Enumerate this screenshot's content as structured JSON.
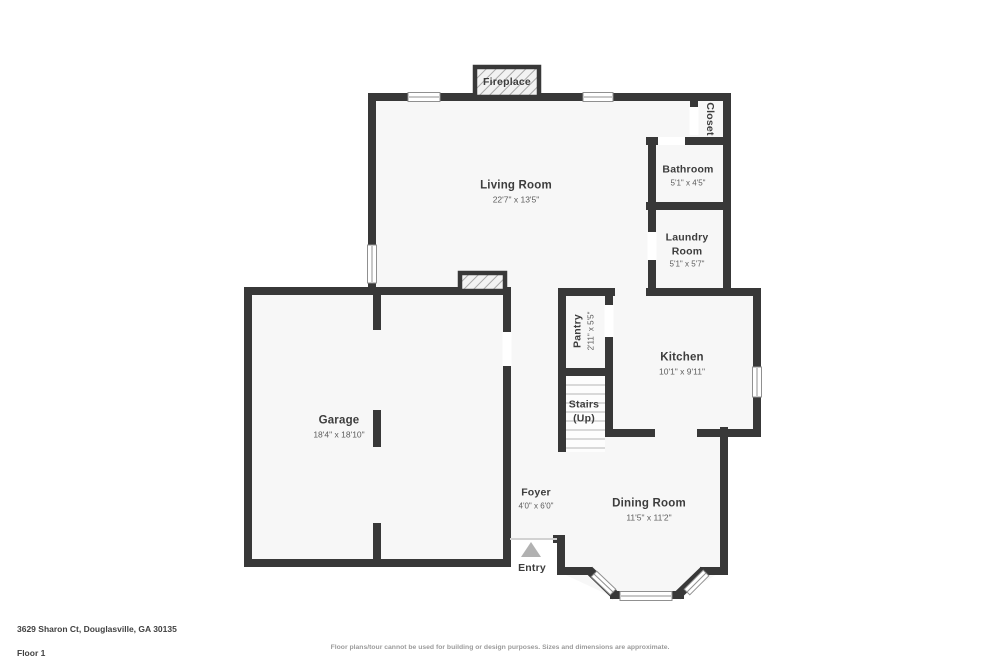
{
  "colors": {
    "wall": "#383838",
    "floor": "#f7f7f7",
    "room_inner": "#fdfdfd",
    "window_frame": "#909090",
    "tread": "#b5b5b5",
    "threshold": "#d2d2d2",
    "hatch_bg": "#f2f2f2",
    "hatch_line": "#a8a8a8",
    "text_primary": "#3d3d3d",
    "text_secondary": "#5c5c5c",
    "entry_arrow": "#b1b1b1",
    "footer_text": "#414141",
    "disclaimer": "#9b9b9b"
  },
  "labels": {
    "living_room": {
      "name": "Living Room",
      "dims": "22'7\" x 13'5\""
    },
    "garage": {
      "name": "Garage",
      "dims": "18'4\" x 18'10\""
    },
    "kitchen": {
      "name": "Kitchen",
      "dims": "10'1\" x 9'11\""
    },
    "dining_room": {
      "name": "Dining Room",
      "dims": "11'5\" x 11'2\""
    },
    "foyer": {
      "name": "Foyer",
      "dims": "4'0\" x 6'0\""
    },
    "bathroom": {
      "name": "Bathroom",
      "dims": "5'1\" x 4'5\""
    },
    "laundry_room": {
      "name": "Laundry Room",
      "dims": "5'1\" x 5'7\""
    },
    "pantry": {
      "name": "Pantry",
      "dims": "2'11\" x 5'5\""
    },
    "closet": {
      "name": "Closet"
    },
    "fireplace": {
      "name": "Fireplace"
    },
    "stairs": {
      "name": "Stairs",
      "sub": "(Up)"
    },
    "entry": {
      "name": "Entry"
    }
  },
  "footer": {
    "address": "3629 Sharon Ct, Douglasville, GA 30135",
    "floor": "Floor 1",
    "disclaimer": "Floor plans/tour cannot be used for building or design purposes. Sizes and dimensions are approximate."
  }
}
